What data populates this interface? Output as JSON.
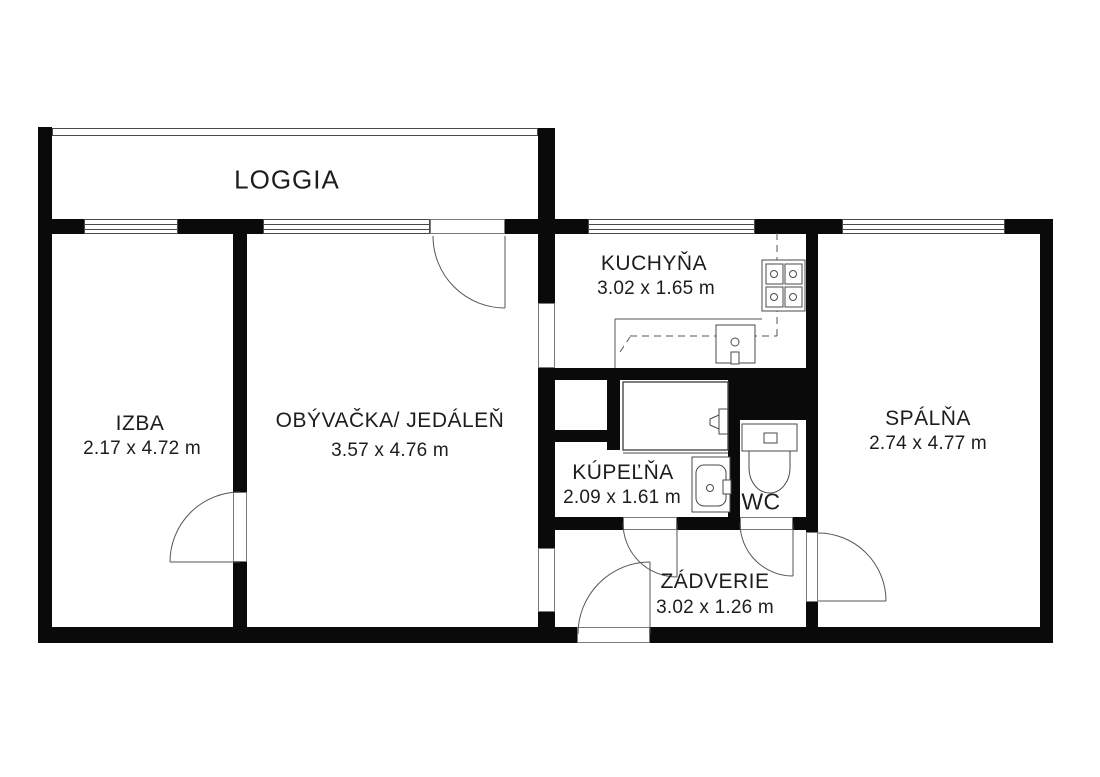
{
  "palette": {
    "background": "#ffffff",
    "wall": "#0a0a0a",
    "thin_line": "#4a4a4a",
    "text": "#1d1d1d"
  },
  "floorplan": {
    "rooms": [
      {
        "name": "LOGGIA",
        "dims": ""
      },
      {
        "name": "IZBA",
        "dims": "2.17 x 4.72 m"
      },
      {
        "name": "OBÝVAČKA/ JEDÁLEŇ",
        "dims": "3.57 x 4.76 m"
      },
      {
        "name": "KUCHYŇA",
        "dims": "3.02 x 1.65 m"
      },
      {
        "name": "KÚPEĽŇA",
        "dims": "2.09 x 1.61 m"
      },
      {
        "name": "WC",
        "dims": ""
      },
      {
        "name": "ZÁDVERIE",
        "dims": "3.02 x 1.26 m"
      },
      {
        "name": "SPÁLŇA",
        "dims": "2.74 x 4.77 m"
      }
    ],
    "fixtures": [
      "stove-icon",
      "kitchen-sink-icon",
      "bathtub-icon",
      "washbasin-icon",
      "toilet-icon"
    ],
    "door_count": 6,
    "window_count": 4
  }
}
